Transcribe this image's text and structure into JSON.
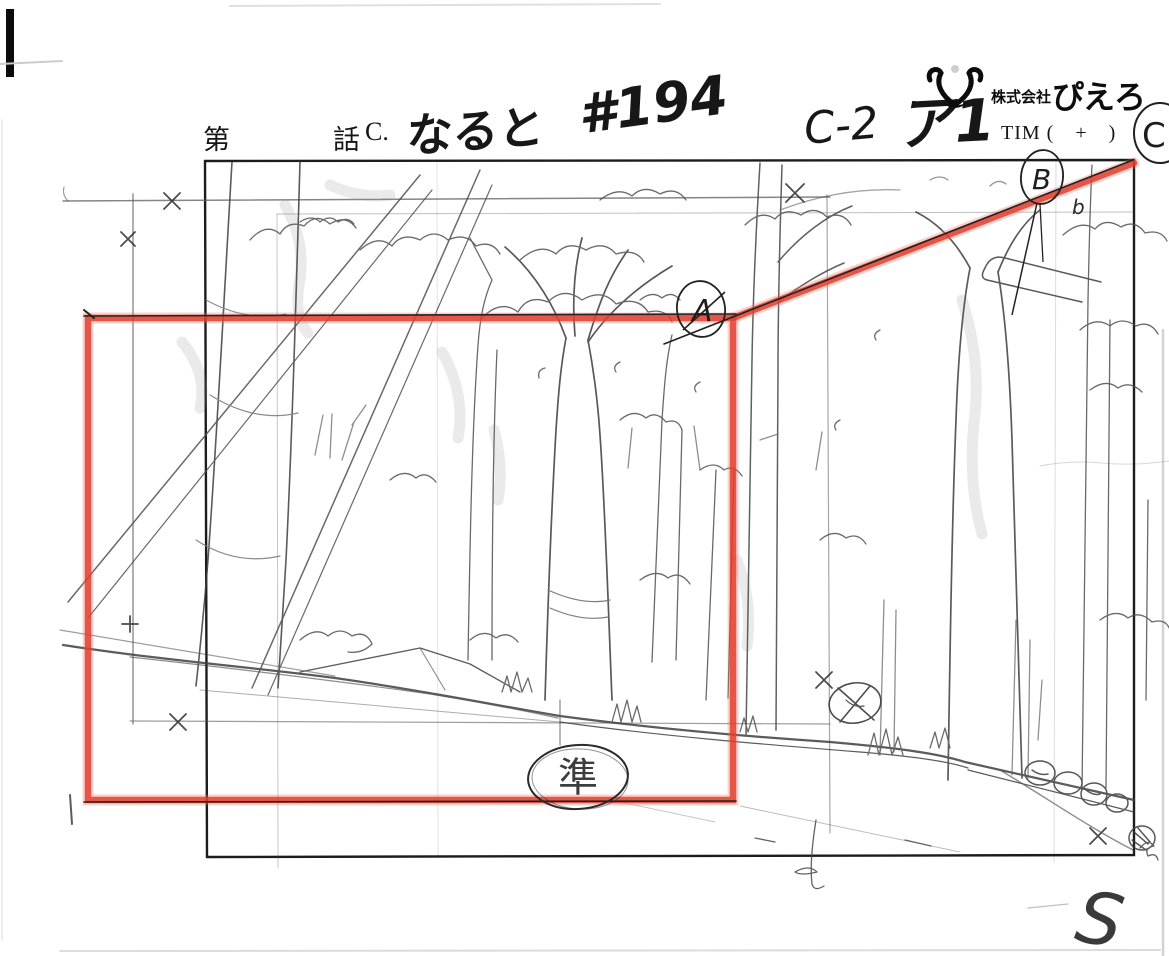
{
  "header": {
    "episode_prefix": "第",
    "episode_suffix": "話",
    "scene_label": "C.",
    "title_handwritten": "なると",
    "episode_number": "#194",
    "cut_note": "C-2",
    "part_note": "ア1",
    "company_prefix": "株式会社",
    "company_name": "ぴえろ",
    "tim_label": "TIM (　+　)",
    "corner_mark": "C"
  },
  "annotations": {
    "frame_corner_label": "A",
    "pan_end_label": "B",
    "approval_stamp": "準",
    "corner_flourish": "S",
    "small_note": "b"
  },
  "colors": {
    "camera_frame_red": "#e23b2b",
    "pencil_gray": "#555555",
    "ink_black": "#1a1a1a"
  }
}
